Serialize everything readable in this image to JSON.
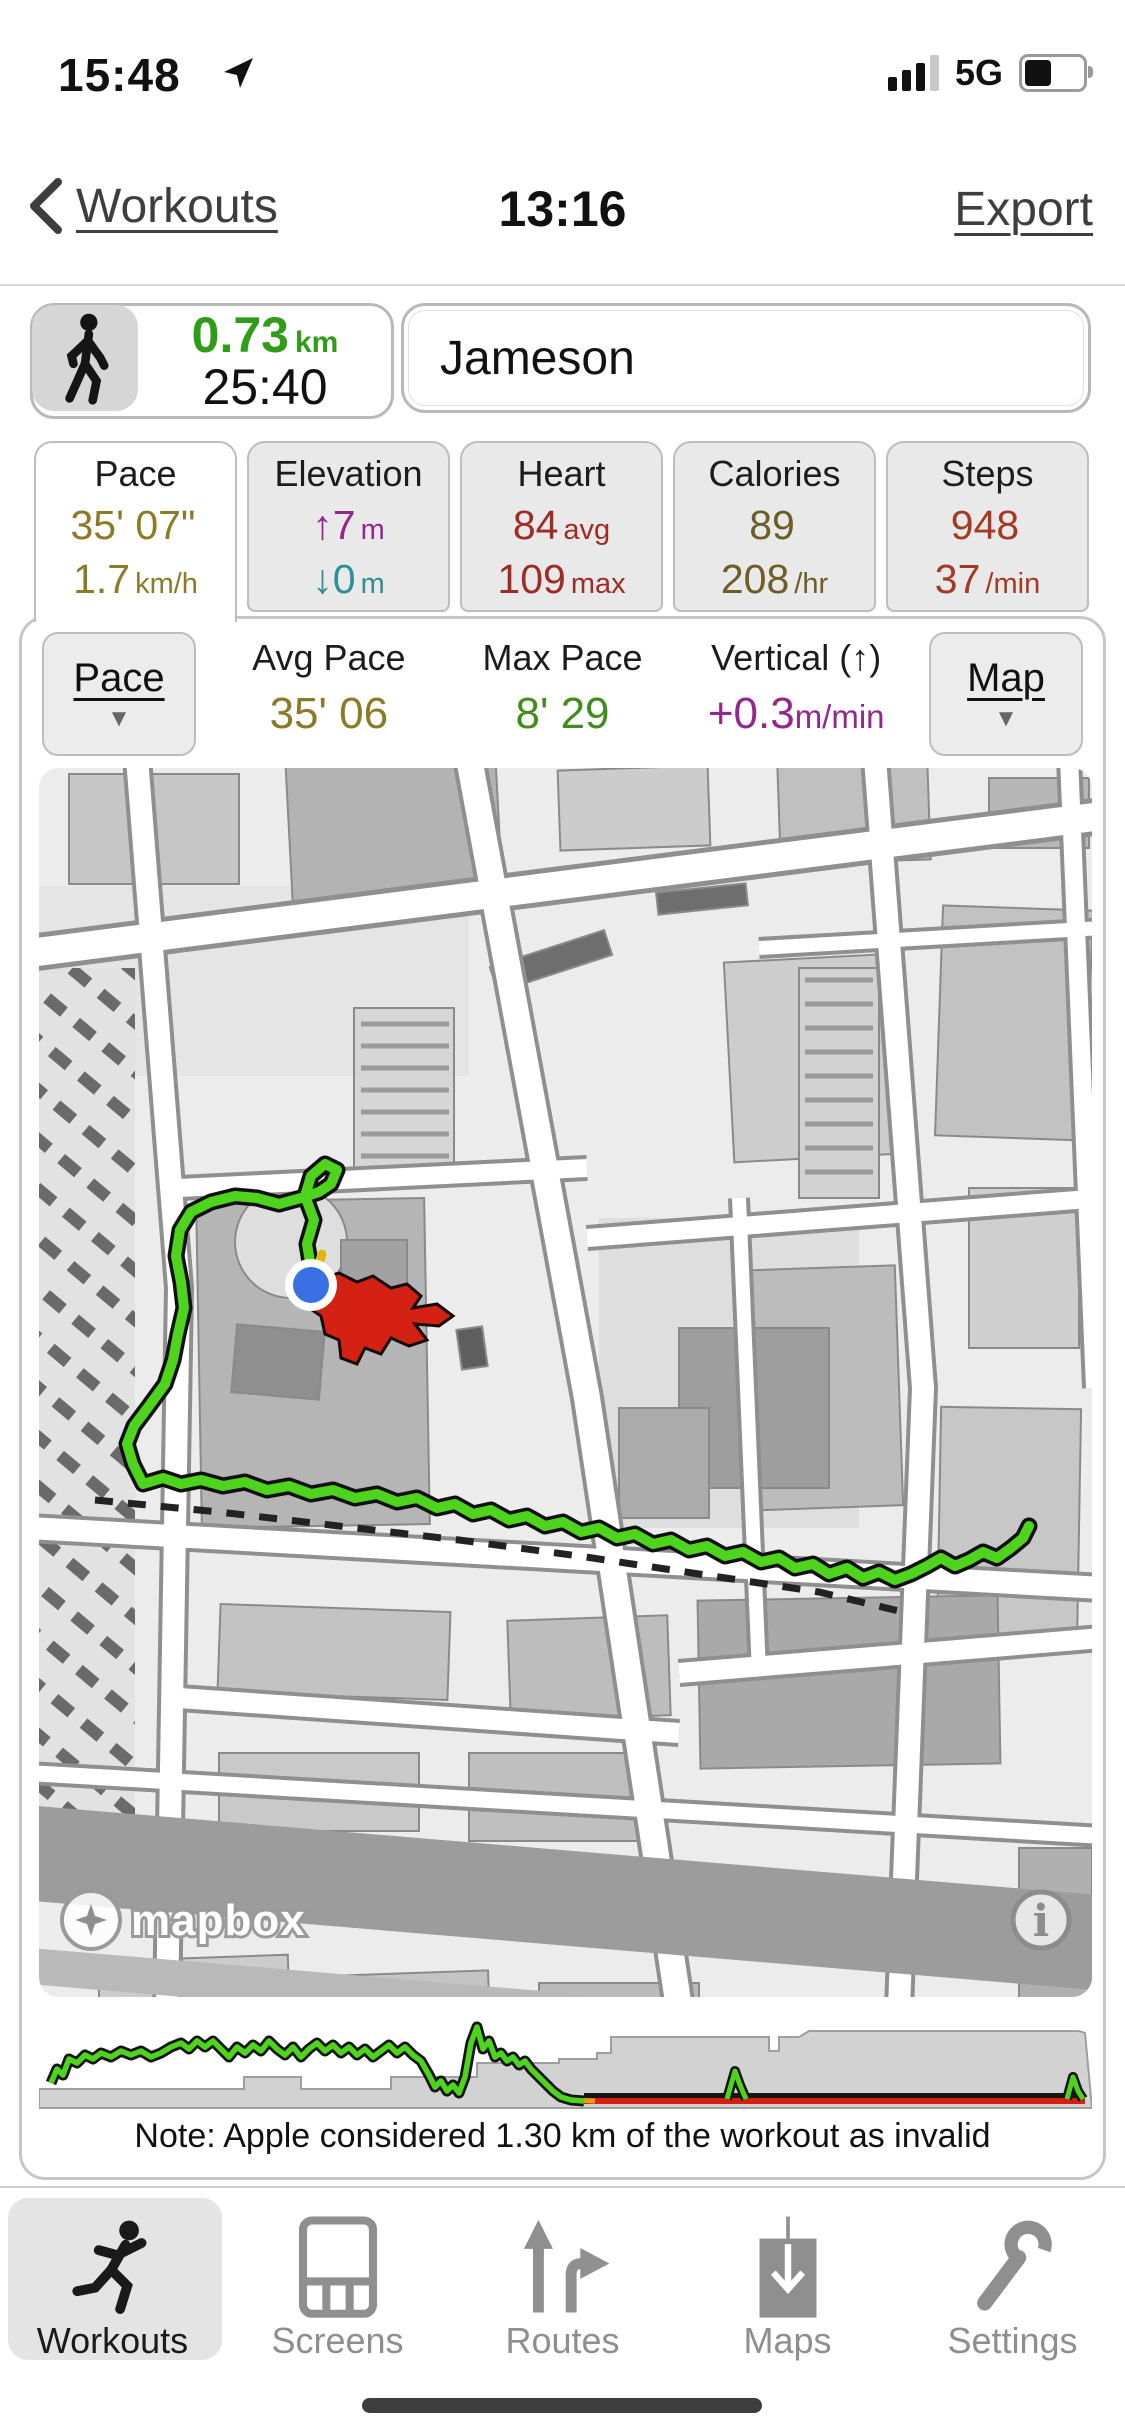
{
  "status_bar": {
    "time": "15:48",
    "network": "5G",
    "battery_percent": 50
  },
  "nav": {
    "back_label": "Workouts",
    "title": "13:16",
    "export_label": "Export"
  },
  "summary": {
    "distance": "0.73",
    "distance_unit": "km",
    "duration": "25:40",
    "workout_name": "Jameson",
    "distance_color": "#2f9d17"
  },
  "stat_tabs": [
    {
      "label": "Pace",
      "value1": "35' 07\"",
      "value1_suffix": "",
      "value2": "1.7",
      "value2_suffix": "km/h",
      "value1_color": "#8b7a26",
      "value2_color": "#8b7a26",
      "selected": true
    },
    {
      "label": "Elevation",
      "value1": "↑7",
      "value1_suffix": "m",
      "value2": "↓0",
      "value2_suffix": "m",
      "value1_color": "#93278f",
      "value2_color": "#2e8f96",
      "selected": false
    },
    {
      "label": "Heart",
      "value1": "84",
      "value1_suffix": "avg",
      "value2": "109",
      "value2_suffix": "max",
      "value1_color": "#9e2b24",
      "value2_color": "#9e2b24",
      "selected": false
    },
    {
      "label": "Calories",
      "value1": "89",
      "value1_suffix": "",
      "value2": "208",
      "value2_suffix": "/hr",
      "value1_color": "#6d5d26",
      "value2_color": "#6d5d26",
      "selected": false
    },
    {
      "label": "Steps",
      "value1": "948",
      "value1_suffix": "",
      "value2": "37",
      "value2_suffix": "/min",
      "value1_color": "#a33a23",
      "value2_color": "#a33a23",
      "selected": false
    }
  ],
  "detail_row": {
    "left_dropdown": "Pace",
    "right_dropdown": "Map",
    "metrics": [
      {
        "label": "Avg Pace",
        "value": "35' 06",
        "suffix": "",
        "color": "#8b7a26"
      },
      {
        "label": "Max Pace",
        "value": "8' 29",
        "suffix": "",
        "color": "#3f8d1d"
      },
      {
        "label": "Vertical (↑)",
        "value": "+0.3",
        "suffix": "m/min",
        "color": "#93278f"
      }
    ]
  },
  "map": {
    "attribution": "mapbox",
    "route_color": "#4fd41d",
    "marker_color": "#d42114",
    "location_dot_color": "#3b6fe4",
    "route_points": [
      [
        272,
        500
      ],
      [
        268,
        476
      ],
      [
        275,
        452
      ],
      [
        266,
        428
      ],
      [
        272,
        408
      ],
      [
        286,
        396
      ],
      [
        298,
        402
      ],
      [
        292,
        416
      ],
      [
        280,
        424
      ],
      [
        262,
        430
      ],
      [
        240,
        436
      ],
      [
        218,
        430
      ],
      [
        196,
        428
      ],
      [
        172,
        434
      ],
      [
        152,
        444
      ],
      [
        141,
        462
      ],
      [
        137,
        488
      ],
      [
        142,
        514
      ],
      [
        145,
        540
      ],
      [
        139,
        566
      ],
      [
        134,
        592
      ],
      [
        126,
        616
      ],
      [
        110,
        638
      ],
      [
        95,
        658
      ],
      [
        88,
        676
      ],
      [
        94,
        696
      ],
      [
        104,
        716
      ],
      [
        124,
        710
      ],
      [
        142,
        716
      ],
      [
        162,
        712
      ],
      [
        184,
        718
      ],
      [
        206,
        714
      ],
      [
        228,
        722
      ],
      [
        250,
        718
      ],
      [
        272,
        726
      ],
      [
        294,
        722
      ],
      [
        316,
        730
      ],
      [
        338,
        726
      ],
      [
        358,
        734
      ],
      [
        378,
        730
      ],
      [
        398,
        740
      ],
      [
        416,
        736
      ],
      [
        434,
        746
      ],
      [
        452,
        742
      ],
      [
        470,
        752
      ],
      [
        488,
        748
      ],
      [
        506,
        758
      ],
      [
        524,
        754
      ],
      [
        542,
        764
      ],
      [
        560,
        760
      ],
      [
        578,
        770
      ],
      [
        596,
        766
      ],
      [
        614,
        776
      ],
      [
        632,
        772
      ],
      [
        650,
        782
      ],
      [
        668,
        778
      ],
      [
        686,
        788
      ],
      [
        704,
        784
      ],
      [
        722,
        794
      ],
      [
        740,
        790
      ],
      [
        756,
        800
      ],
      [
        774,
        796
      ],
      [
        790,
        806
      ],
      [
        808,
        800
      ],
      [
        824,
        810
      ],
      [
        840,
        804
      ],
      [
        856,
        812
      ],
      [
        872,
        806
      ],
      [
        888,
        798
      ],
      [
        902,
        790
      ],
      [
        916,
        798
      ],
      [
        930,
        792
      ],
      [
        944,
        784
      ],
      [
        958,
        790
      ],
      [
        972,
        780
      ],
      [
        984,
        770
      ],
      [
        990,
        758
      ]
    ],
    "invalid_points": [
      [
        56,
        732
      ],
      [
        180,
        744
      ],
      [
        300,
        758
      ],
      [
        420,
        772
      ],
      [
        540,
        788
      ],
      [
        660,
        806
      ],
      [
        780,
        824
      ],
      [
        860,
        843
      ]
    ]
  },
  "profile_chart": {
    "line_color": "#4fd41d",
    "invalid_color": "#d6200f",
    "pace_points": [
      [
        12,
        70
      ],
      [
        18,
        56
      ],
      [
        24,
        62
      ],
      [
        30,
        46
      ],
      [
        38,
        50
      ],
      [
        46,
        42
      ],
      [
        54,
        46
      ],
      [
        62,
        40
      ],
      [
        72,
        44
      ],
      [
        82,
        38
      ],
      [
        92,
        42
      ],
      [
        102,
        38
      ],
      [
        112,
        44
      ],
      [
        122,
        40
      ],
      [
        132,
        34
      ],
      [
        142,
        30
      ],
      [
        150,
        36
      ],
      [
        158,
        28
      ],
      [
        166,
        34
      ],
      [
        174,
        28
      ],
      [
        182,
        36
      ],
      [
        190,
        44
      ],
      [
        198,
        34
      ],
      [
        206,
        40
      ],
      [
        214,
        32
      ],
      [
        222,
        38
      ],
      [
        230,
        28
      ],
      [
        238,
        36
      ],
      [
        246,
        42
      ],
      [
        254,
        34
      ],
      [
        262,
        44
      ],
      [
        270,
        36
      ],
      [
        278,
        30
      ],
      [
        286,
        38
      ],
      [
        294,
        32
      ],
      [
        302,
        40
      ],
      [
        310,
        34
      ],
      [
        318,
        42
      ],
      [
        326,
        36
      ],
      [
        334,
        44
      ],
      [
        342,
        38
      ],
      [
        350,
        32
      ],
      [
        358,
        40
      ],
      [
        366,
        34
      ],
      [
        374,
        42
      ],
      [
        382,
        48
      ],
      [
        390,
        62
      ],
      [
        396,
        74
      ],
      [
        402,
        68
      ],
      [
        408,
        78
      ],
      [
        414,
        72
      ],
      [
        420,
        80
      ],
      [
        426,
        64
      ],
      [
        432,
        30
      ],
      [
        438,
        14
      ],
      [
        444,
        36
      ],
      [
        450,
        28
      ],
      [
        456,
        44
      ],
      [
        462,
        40
      ],
      [
        468,
        48
      ],
      [
        474,
        44
      ],
      [
        480,
        52
      ],
      [
        486,
        48
      ],
      [
        492,
        56
      ],
      [
        498,
        62
      ],
      [
        506,
        70
      ],
      [
        514,
        78
      ],
      [
        522,
        84
      ],
      [
        532,
        87
      ],
      [
        545,
        88
      ]
    ],
    "invalid_x": [
      545,
      1046
    ],
    "invalid_y": 88,
    "mid_spike": [
      [
        688,
        86
      ],
      [
        696,
        58
      ],
      [
        701,
        72
      ],
      [
        707,
        86
      ]
    ],
    "end_spike": [
      [
        1028,
        86
      ],
      [
        1034,
        64
      ],
      [
        1039,
        78
      ],
      [
        1044,
        86
      ]
    ],
    "elevation_points": [
      [
        0,
        76
      ],
      [
        205,
        76
      ],
      [
        205,
        64
      ],
      [
        262,
        64
      ],
      [
        262,
        76
      ],
      [
        352,
        76
      ],
      [
        352,
        64
      ],
      [
        438,
        64
      ],
      [
        438,
        50
      ],
      [
        520,
        50
      ],
      [
        520,
        46
      ],
      [
        558,
        46
      ],
      [
        558,
        40
      ],
      [
        572,
        40
      ],
      [
        572,
        24
      ],
      [
        730,
        24
      ],
      [
        730,
        38
      ],
      [
        740,
        38
      ],
      [
        740,
        24
      ],
      [
        760,
        24
      ],
      [
        770,
        18
      ],
      [
        1040,
        18
      ],
      [
        1046,
        20
      ]
    ]
  },
  "note": "Note: Apple considered 1.30 km of the workout as invalid",
  "tab_bar": [
    {
      "label": "Workouts",
      "selected": true
    },
    {
      "label": "Screens",
      "selected": false
    },
    {
      "label": "Routes",
      "selected": false
    },
    {
      "label": "Maps",
      "selected": false
    },
    {
      "label": "Settings",
      "selected": false
    }
  ]
}
